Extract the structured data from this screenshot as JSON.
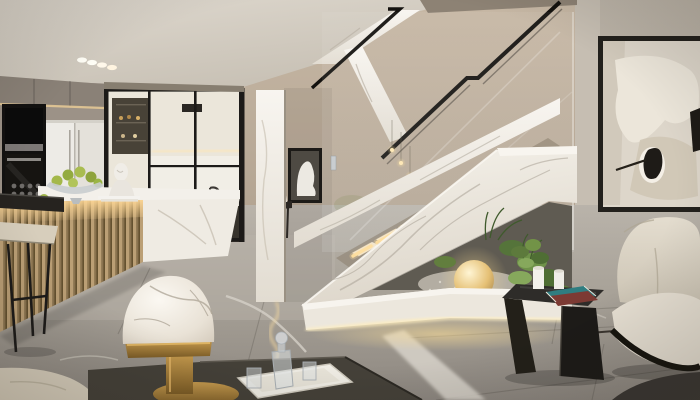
{
  "scene": {
    "title": "Modern duplex interior with white marble staircase, open kitchen and lounge",
    "description": "Photorealistic 3D interior render: open kitchen with glass partition and slatted wood island on the left, central white marble staircase with glass balustrade and LED-lit treads over a pebble garden with a glowing sphere lamp, cream lounge chair and large abstract artwork on the right, glossy grey marble floor.",
    "areas": {
      "kitchen": {
        "label": "Open kitchen",
        "objects": [
          "built-in black oven tower",
          "white double-door fridge",
          "black-framed glass partition",
          "wood-slat island with marble top",
          "breakfast counter",
          "bar stool",
          "glass fruit bowl with green pears",
          "white bust sculpture",
          "ceiling spotlights"
        ]
      },
      "staircase": {
        "label": "Marble staircase",
        "objects": [
          "white marble balustrade",
          "glass railing panels",
          "black metal handrails",
          "LED-lit treads",
          "pebble garden",
          "glowing sphere lamp",
          "green plants",
          "marble base plinth with LED strip",
          "mini pendant lights"
        ]
      },
      "hallway": {
        "label": "Back hallway",
        "objects": [
          "marble pillar with LED strip",
          "framed figure artwork",
          "black console with bust",
          "gold ornament"
        ]
      },
      "living": {
        "label": "Lounge corner",
        "objects": [
          "large framed abstract artwork",
          "cream boucle wing chair",
          "black angular side table",
          "white candles",
          "magazines",
          "dark rug"
        ]
      },
      "foreground": {
        "label": "Foreground",
        "objects": [
          "marble dome table lamp with brass base",
          "dark console table",
          "white serving tray",
          "glass decanter and glasses",
          "beige sofa corner"
        ]
      }
    },
    "palette": {
      "wall_taupe": "#b3a493",
      "ceiling": "#d8d2c8",
      "marble_white": "#f2eee7",
      "floor_grey": "#a39d94",
      "wood_slat": "#b2976c",
      "led_warm": "#ffe2a8",
      "brass": "#a8803d",
      "plant_green": "#6f9249",
      "black_metal": "#1b1917",
      "cream_fabric": "#ddd6c7",
      "sphere_glow": "#f0d08e",
      "book_teal": "#2f7d80"
    }
  }
}
